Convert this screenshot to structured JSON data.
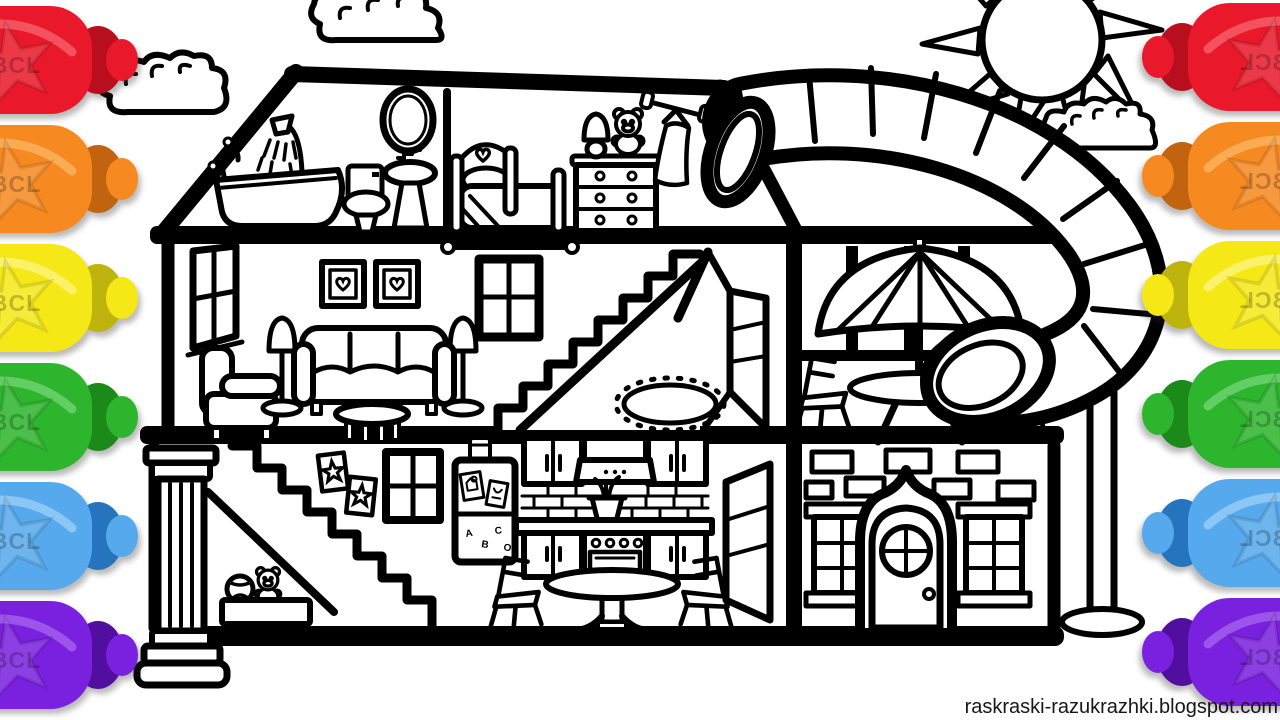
{
  "watermark": {
    "text": "raskraski-razukrazhki.blogspot.com"
  },
  "markers": {
    "brand_label": "BCL",
    "sides": [
      "left",
      "right"
    ],
    "colors": [
      {
        "name": "red",
        "body": "#E9192B",
        "shade": "#B90E1D",
        "light": "#F4525F",
        "css": "--b:#E9192B;--s:#B90E1D;--l:#F4525F"
      },
      {
        "name": "orange",
        "body": "#F6891F",
        "shade": "#C26310",
        "light": "#FAAC55",
        "css": "--b:#F6891F;--s:#C26310;--l:#FAAC55"
      },
      {
        "name": "yellow",
        "body": "#F5E816",
        "shade": "#BFB30E",
        "light": "#FAF269",
        "css": "--b:#F5E816;--s:#BFB30E;--l:#FAF269"
      },
      {
        "name": "green",
        "body": "#2DB62D",
        "shade": "#1B8A1B",
        "light": "#63CE63",
        "css": "--b:#2DB62D;--s:#1B8A1B;--l:#63CE63"
      },
      {
        "name": "blue",
        "body": "#55A9EC",
        "shade": "#2673BE",
        "light": "#8CC6F4",
        "css": "--b:#55A9EC;--s:#2673BE;--l:#8CC6F4"
      },
      {
        "name": "purple",
        "body": "#7A20DF",
        "shade": "#520E9F",
        "light": "#9B55EB",
        "css": "--b:#7A20DF;--s:#520E9F;--l:#9B55EB"
      }
    ]
  },
  "fridge": {
    "magnets": [
      "A",
      "B",
      "C",
      "O"
    ]
  },
  "scene": {
    "background_color": "#FFFFFF",
    "line_color": "#000000",
    "objects": [
      "sun",
      "clouds",
      "dollhouse cross-section",
      "attic bathroom",
      "attic bedroom",
      "living room",
      "hallway",
      "patio with umbrella table",
      "playroom nook",
      "kitchen",
      "brick facade with front door",
      "tube water slide",
      "slide support pole",
      "classical column"
    ]
  }
}
